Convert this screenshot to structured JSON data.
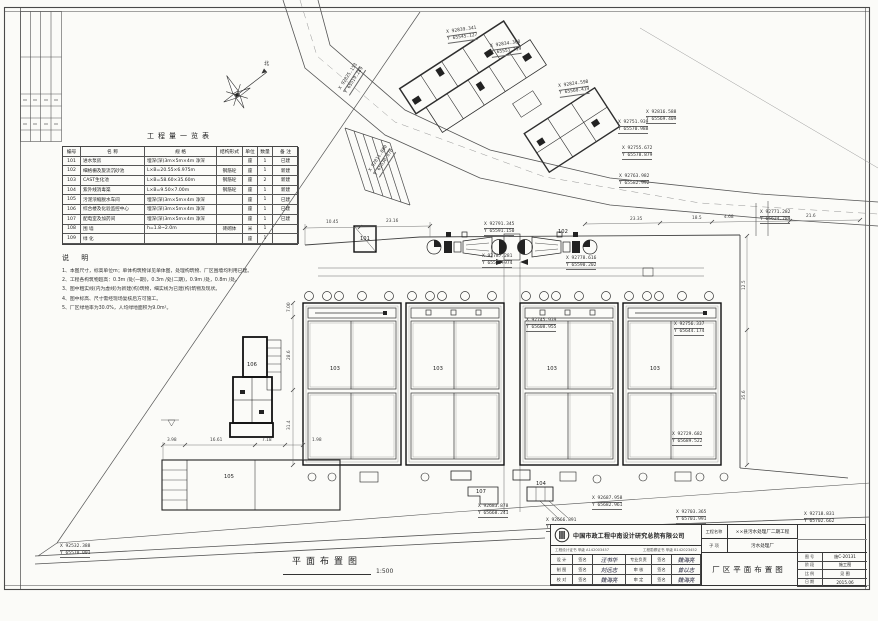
{
  "quantity_table": {
    "title": "工程量一览表",
    "headers": [
      "编号",
      "名  称",
      "规  格",
      "结构形式",
      "单位",
      "数量",
      "备 注"
    ],
    "rows": [
      [
        "101",
        "进水泵房",
        "埋深(深)3m×5m×4m 净深",
        "",
        "座",
        "1",
        "已建"
      ],
      [
        "102",
        "细格栅及旋流沉砂池",
        "L×B=20.55×6.975m",
        "钢筋砼",
        "座",
        "1",
        "新建"
      ],
      [
        "103",
        "CAST生化池",
        "L×B=58.60×35.60m",
        "钢筋砼",
        "座",
        "2",
        "新建"
      ],
      [
        "104",
        "紫外线消毒渠",
        "L×B=9.50×7.00m",
        "钢筋砼",
        "座",
        "1",
        "新建"
      ],
      [
        "105",
        "污泥浓缩脱水车间",
        "埋深(深)3m×5m×4m 净深",
        "",
        "座",
        "1",
        "已建"
      ],
      [
        "106",
        "综合楼及化验监控中心",
        "埋深(深)3m×5m×4m 净深",
        "",
        "座",
        "1",
        "已建"
      ],
      [
        "107",
        "配电室及加药间",
        "埋深(深)3m×5m×4m 净深",
        "",
        "座",
        "1",
        "已建"
      ],
      [
        "108",
        "围 墙",
        "h=1.8~2.0m",
        "砖砌体",
        "米",
        "1",
        ""
      ],
      [
        "109",
        "绿 化",
        "",
        "",
        "座",
        "1",
        ""
      ]
    ]
  },
  "notes": {
    "title": "说 明",
    "items": [
      "1、本图尺寸，标高单位m；单体构筑物详见单体图，处理构筑物、厂区围墙均利用已建。",
      "2、工程各构筑物超高：0.3m /处(一期)，0.3m /处(二期)，0.9m /处，0.8m /处。",
      "3、图中粗实线(内为虚线)为新建(构)筑物，细实线为已建(构)筑物及现状。",
      "4、图中标高、尺寸需经现场复核后方可施工。",
      "5、厂区绿地率为30.0%，人均绿地面积为9.0m²。"
    ]
  },
  "plan_title": {
    "text": "平面布置图",
    "scale": "1:500"
  },
  "structure_labels": [
    {
      "t": "北",
      "x": 264,
      "y": 60,
      "n": "north-label"
    },
    {
      "t": "101",
      "x": 360,
      "y": 236
    },
    {
      "t": "102",
      "x": 558,
      "y": 229
    },
    {
      "t": "103",
      "x": 330,
      "y": 366
    },
    {
      "t": "103",
      "x": 433,
      "y": 366
    },
    {
      "t": "103",
      "x": 547,
      "y": 366
    },
    {
      "t": "103",
      "x": 650,
      "y": 366
    },
    {
      "t": "104",
      "x": 536,
      "y": 481
    },
    {
      "t": "105",
      "x": 224,
      "y": 474
    },
    {
      "t": "106",
      "x": 247,
      "y": 362
    },
    {
      "t": "107",
      "x": 476,
      "y": 489
    }
  ],
  "coordinate_labels": [
    {
      "x": 60,
      "y": 544,
      "X": "X 92532.388",
      "Y": "Y 65570.001"
    },
    {
      "x": 618,
      "y": 120,
      "X": "X 92751.939",
      "Y": "Y 65570.988"
    },
    {
      "x": 622,
      "y": 146,
      "X": "X 92755.672",
      "Y": "Y 65578.879"
    },
    {
      "x": 619,
      "y": 174,
      "X": "X 92763.982",
      "Y": "Y 65582.992"
    },
    {
      "x": 760,
      "y": 210,
      "X": "X 92771.282",
      "Y": "Y 65624.789"
    },
    {
      "x": 482,
      "y": 254,
      "X": "X 92787.281",
      "Y": "Y 65585.974"
    },
    {
      "x": 566,
      "y": 256,
      "X": "X 92778.616",
      "Y": "Y 65590.202"
    },
    {
      "x": 484,
      "y": 222,
      "X": "X 92791.345",
      "Y": "Y 65591.150"
    },
    {
      "x": 526,
      "y": 318,
      "X": "X 92745.939",
      "Y": "Y 65608.955"
    },
    {
      "x": 674,
      "y": 322,
      "X": "X 92756.337",
      "Y": "Y 65644.174"
    },
    {
      "x": 672,
      "y": 432,
      "X": "X 92729.682",
      "Y": "Y 65689.522"
    },
    {
      "x": 478,
      "y": 504,
      "X": "X 92683.878",
      "Y": "Y 65668.241"
    },
    {
      "x": 592,
      "y": 496,
      "X": "X 92687.958",
      "Y": "Y 65682.961"
    },
    {
      "x": 546,
      "y": 518,
      "X": "X 92666.891",
      "Y": "Y 65665.311"
    },
    {
      "x": 676,
      "y": 510,
      "X": "X 92703.365",
      "Y": "Y 65701.991"
    },
    {
      "x": 804,
      "y": 512,
      "X": "X 92718.831",
      "Y": "Y 65702.662"
    },
    {
      "x": 338,
      "y": 88,
      "X": "X 92825.153",
      "Y": "Y 65519.289",
      "rot": -57
    },
    {
      "x": 368,
      "y": 170,
      "X": "X 92811.080",
      "Y": "Y 65530.870",
      "rot": -57
    },
    {
      "x": 446,
      "y": 30,
      "X": "X 92839.341",
      "Y": "Y 65545.127",
      "rot": -8
    },
    {
      "x": 490,
      "y": 44,
      "X": "X 92834.368",
      "Y": "Y 65551.719",
      "rot": -8
    },
    {
      "x": 558,
      "y": 84,
      "X": "X 92824.598",
      "Y": "Y 65560.419",
      "rot": -8
    },
    {
      "x": 646,
      "y": 110,
      "X": "X 92816.588",
      "Y": "Y 65569.409"
    }
  ],
  "dimension_labels": [
    {
      "t": "10.45",
      "x": 326,
      "y": 220
    },
    {
      "t": "23.16",
      "x": 386,
      "y": 219
    },
    {
      "t": "23.35",
      "x": 630,
      "y": 217
    },
    {
      "t": "18.5",
      "x": 692,
      "y": 216
    },
    {
      "t": "4.68",
      "x": 724,
      "y": 215
    },
    {
      "t": "21.6",
      "x": 806,
      "y": 214
    },
    {
      "t": "3.98",
      "x": 167,
      "y": 438
    },
    {
      "t": "16.61",
      "x": 210,
      "y": 438
    },
    {
      "t": "7.18",
      "x": 262,
      "y": 438
    },
    {
      "t": "1.98",
      "x": 312,
      "y": 438
    },
    {
      "t": "7.00",
      "x": 287,
      "y": 312,
      "rot": -90
    },
    {
      "t": "28.6",
      "x": 287,
      "y": 360,
      "rot": -90
    },
    {
      "t": "31.4",
      "x": 287,
      "y": 430,
      "rot": -90
    },
    {
      "t": "12.5",
      "x": 742,
      "y": 290,
      "rot": -90
    },
    {
      "t": "35.6",
      "x": 742,
      "y": 400,
      "rot": -90
    }
  ],
  "title_block": {
    "company": "中国市政工程中南设计研究总院有限公司",
    "cert_left": "工程设计证书 甲级 A142003457",
    "cert_right": "工程勘察证书 甲级 B142023452",
    "sign_rows": [
      [
        "设 计",
        "签名",
        "汪书华",
        "专业负责",
        "签名",
        "魏海亮"
      ],
      [
        "制 图",
        "签名",
        "刘远志",
        "审 核",
        "签名",
        "曾以志"
      ],
      [
        "校 对",
        "签名",
        "魏海亮",
        "审 定",
        "签名",
        "魏海亮"
      ]
    ],
    "project_label": "工程名称",
    "project_value": "××县污水处理厂二期工程",
    "subitem_label": "子 项",
    "subitem_value": "污水处理厂",
    "drawing_title": "厂区平面布置图",
    "fields": [
      [
        "图 号",
        "施C-20131"
      ],
      [
        "阶 段",
        "施工图"
      ],
      [
        "比 例",
        "见 图"
      ],
      [
        "日 期",
        "2015.06"
      ]
    ]
  }
}
